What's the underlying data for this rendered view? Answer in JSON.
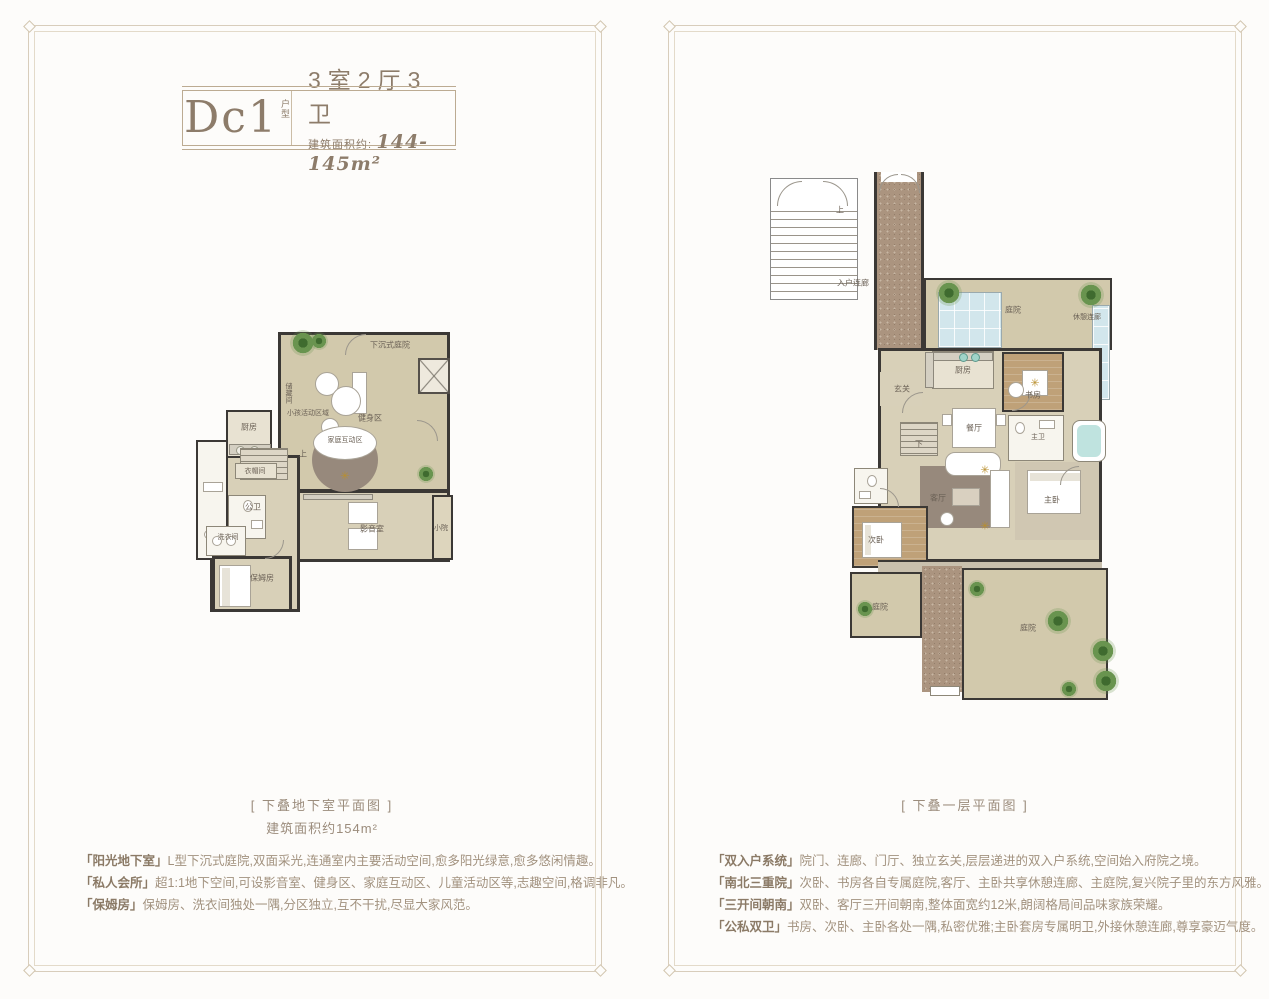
{
  "header": {
    "unit_code": "Dc1",
    "unit_tag_top": "户",
    "unit_tag_bottom": "型",
    "layout": "3室2厅3卫",
    "area_label": "建筑面积约:",
    "area_value": "144-145m²"
  },
  "left_panel": {
    "caption": "[ 下叠地下室平面图 ]",
    "caption_area": "建筑面积约154m²",
    "features": [
      {
        "title": "「阳光地下室」",
        "text": "L型下沉式庭院,双面采光,连通室内主要活动空间,愈多阳光绿意,愈多悠闲情趣。"
      },
      {
        "title": "「私人会所」",
        "text": "超1:1地下空间,可设影音室、健身区、家庭互动区、儿童活动区等,志趣空间,格调非凡。"
      },
      {
        "title": "「保姆房」",
        "text": "保姆房、洗衣间独处一隅,分区独立,互不干扰,尽显大家风范。"
      }
    ],
    "plan_labels": {
      "sunken_courtyard": "下沉式庭院",
      "gym": "健身区",
      "kids_zone": "小孩活动区域",
      "family_zone": "家庭互动区",
      "storage": "储藏间",
      "kitchen": "厨房",
      "cloakroom": "衣帽间",
      "up": "上",
      "public_bath": "公卫",
      "laundry": "洗衣间",
      "nanny_room": "保姆房",
      "media_room": "影音室",
      "small_yard": "小院"
    }
  },
  "right_panel": {
    "caption": "[ 下叠一层平面图 ]",
    "features": [
      {
        "title": "「双入户系统」",
        "text": "院门、连廊、门厅、独立玄关,层层递进的双入户系统,空间始入府院之境。"
      },
      {
        "title": "「南北三重院」",
        "text": "次卧、书房各自专属庭院,客厅、主卧共享休憩连廊、主庭院,复兴院子里的东方风雅。"
      },
      {
        "title": "「三开间朝南」",
        "text": "双卧、客厅三开间朝南,整体面宽约12米,朗阔格局间品味家族荣耀。"
      },
      {
        "title": "「公私双卫」",
        "text": "书房、次卧、主卧各处一隅,私密优雅;主卧套房专属明卫,外接休憩连廊,尊享豪迈气度。"
      }
    ],
    "plan_labels": {
      "entry_corridor": "入户连廊",
      "up": "上",
      "down": "下",
      "courtyard_top": "庭院",
      "rest_corridor": "休憩连廊",
      "kitchen": "厨房",
      "study": "书房",
      "foyer": "玄关",
      "dining": "餐厅",
      "living": "客厅",
      "bedroom2": "次卧",
      "master_bedroom": "主卧",
      "master_bath": "主卫",
      "courtyard_left": "庭院",
      "courtyard_main": "庭院"
    }
  },
  "icons": {
    "fan_symbol": "✳"
  },
  "colors": {
    "frame": "#d8cdbb",
    "wall": "#3b3835",
    "floor_tan": "#d8d0b8",
    "wood": "#bfa178",
    "glass_blue": "#d2e6ec",
    "plant_green": "#5d8544",
    "accent_text": "#8d7c6a"
  }
}
